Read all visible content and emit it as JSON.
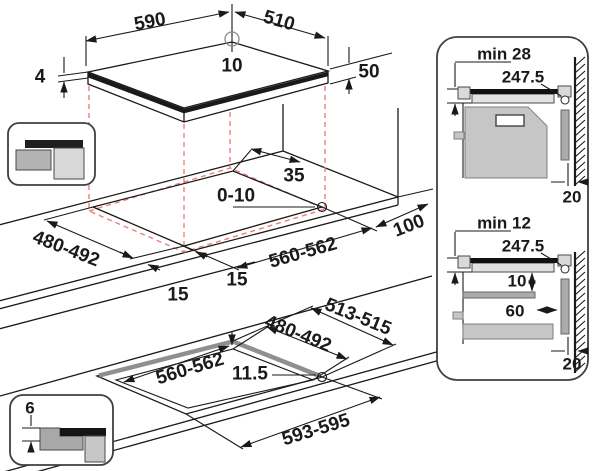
{
  "diagram_title": "hob-installation-dimensions",
  "colors": {
    "line": "#1a1a1a",
    "projection_red": "#ee7d7d",
    "cabinet_gray": "#c6c6c6"
  },
  "hob": {
    "width": "590",
    "depth": "510",
    "hole_offset": "10",
    "glass_thickness": "4",
    "body_height": "50"
  },
  "worktop_cutout": {
    "rear_clearance": "35",
    "corner_radius": "0-10",
    "cutout_depth": "480-492",
    "front_clearance_left": "15",
    "front_clearance_right": "15",
    "cutout_width": "560-562",
    "side_clearance": "100"
  },
  "flush_cutout": {
    "outer_depth": "513-515",
    "inner_depth": "480-492",
    "inner_width": "560-562",
    "ledge_width": "11.5",
    "outer_width": "593-595",
    "recess_depth": "6"
  },
  "section_oven": {
    "title": "min 28",
    "duct_dim": "247.5",
    "wall_gap": "20"
  },
  "section_drawer": {
    "title": "min 12",
    "duct_dim": "247.5",
    "shelf_gap": "10",
    "shelf_clearance": "60",
    "wall_gap": "20"
  }
}
